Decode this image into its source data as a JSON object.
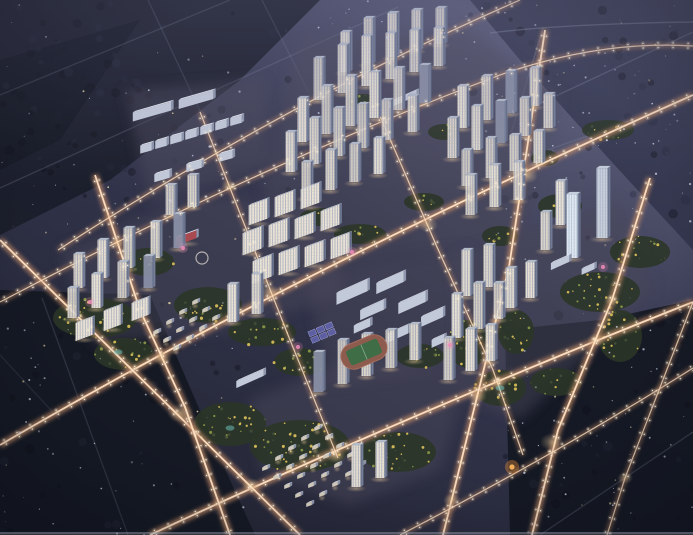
{
  "scene": {
    "title": "aerial-night-render-residential-masterplan",
    "canvas": {
      "w": 693,
      "h": 535
    },
    "palette": {
      "sky_top_right": "#6a6c88",
      "bg_light": "#4b4d68",
      "bg_dark": "#1e202c",
      "forest_dark": "#141823",
      "forest_tl": "#1a1d29",
      "forest_tr": "#2b2e44",
      "road_glow": "#c08a68",
      "road_core": "#ffe3c4",
      "lamp": "#fff2d8",
      "tower_lit": "#ebe4d6",
      "tower_stripe": "#a8aec2",
      "tower_floor": "#cfcabe",
      "tower_shade": "#747e97",
      "tower_shade_stripe": "#5f6882",
      "tower_roof": "#bcc3d1",
      "office_lit": "#e3ebf4",
      "office_stripe": "#b5c4d8",
      "office_roof": "#d4dde9",
      "school_front": "#c2c9d8",
      "school_roof": "#e3e7f0",
      "school_side": "#8d96ac",
      "villa_front": "#cfc7b8",
      "villa_roof": "#dde2ec",
      "villa_side": "#8a92a8",
      "green_base": "#2b3527",
      "tree_lit": "#d6bc58",
      "tree_mid": "#9aa84e",
      "tree_dark": "#46523a",
      "field_track": "#8e5c4e",
      "field_grass": "#3e6d46",
      "court_blue": "#5d5fa2",
      "court_line": "#9a9cd0",
      "pink_accent": "#ef8cba",
      "teal_accent": "#6fc9c4",
      "orange_accent": "#ffb95e",
      "kindergarten_red": "#a84a50",
      "speckle": "#d3d8ea",
      "bottom_strip": "#9fa3b2"
    },
    "roads": {
      "tier1": [
        {
          "d": "M 0,445 Q 300,270 693,95"
        },
        {
          "d": "M 150,535 Q 400,418 693,302"
        },
        {
          "d": "M 0,240 L 300,535"
        },
        {
          "d": "M 95,175 L 140,310 L 185,407 L 230,535"
        },
        {
          "d": "M 545,30 L 509,267 L 443,535"
        },
        {
          "d": "M 650,178 L 612,300 L 558,430 L 532,535"
        }
      ],
      "tier2": [
        {
          "d": "M 0,302 Q 260,165 500,75 Q 600,40 693,46"
        },
        {
          "d": "M 400,535 Q 560,452 693,368"
        },
        {
          "d": "M 200,112 L 290,340 L 338,458"
        },
        {
          "d": "M 373,100 L 437,247 L 493,370 L 523,455"
        },
        {
          "d": "M 693,302 L 625,478 L 607,535"
        },
        {
          "d": "M 58,250 Q 290,100 520,0"
        }
      ],
      "faint": [
        {
          "d": "M 0,95 L 230,0",
          "o": 0.22
        },
        {
          "d": "M 0,188 L 398,7",
          "o": 0.25
        },
        {
          "d": "M 148,0 L 208,128",
          "o": 0.2
        },
        {
          "d": "M 262,0 L 309,93",
          "o": 0.18
        },
        {
          "d": "M 500,122 L 693,32",
          "o": 0.3
        },
        {
          "d": "M 520,160 L 693,98",
          "o": 0.26
        },
        {
          "d": "M 490,33 Q 560,24 693,22",
          "o": 0.38
        },
        {
          "d": "M 543,28 L 509,140",
          "o": 0.3
        },
        {
          "d": "M 42,298 L 128,535",
          "o": 0.2
        },
        {
          "d": "M 540,535 L 693,432",
          "o": 0.25
        },
        {
          "d": "M 0,355 L 60,420",
          "o": 0.15
        }
      ]
    },
    "intersections": [
      [
        180,
        413,
        13
      ],
      [
        162,
        358,
        10
      ],
      [
        270,
        292,
        10
      ],
      [
        428,
        225,
        10
      ],
      [
        528,
        176,
        10
      ],
      [
        336,
        456,
        10
      ],
      [
        477,
        396,
        10
      ],
      [
        552,
        442,
        12
      ],
      [
        229,
        186,
        8
      ],
      [
        117,
        243,
        7
      ],
      [
        378,
        113,
        8
      ],
      [
        498,
        382,
        9
      ],
      [
        596,
        340,
        9
      ],
      [
        452,
        500,
        9
      ],
      [
        251,
        485,
        9
      ],
      [
        612,
        300,
        8
      ],
      [
        625,
        478,
        8
      ]
    ],
    "pads": [
      {
        "pts": [
          [
            300,
            38
          ],
          [
            470,
            30
          ],
          [
            560,
            95
          ],
          [
            525,
            235
          ],
          [
            300,
            272
          ],
          [
            262,
            190
          ]
        ]
      },
      {
        "pts": [
          [
            60,
            250
          ],
          [
            200,
            195
          ],
          [
            330,
            210
          ],
          [
            345,
            295
          ],
          [
            230,
            330
          ],
          [
            95,
            345
          ]
        ]
      },
      {
        "pts": [
          [
            305,
            272
          ],
          [
            470,
            248
          ],
          [
            505,
            362
          ],
          [
            330,
            385
          ]
        ]
      },
      {
        "pts": [
          [
            250,
            400
          ],
          [
            350,
            360
          ],
          [
            470,
            370
          ],
          [
            440,
            470
          ],
          [
            350,
            505
          ],
          [
            262,
            470
          ]
        ]
      },
      {
        "pts": [
          [
            455,
            255
          ],
          [
            620,
            200
          ],
          [
            655,
            290
          ],
          [
            520,
            420
          ],
          [
            460,
            395
          ]
        ]
      },
      {
        "pts": [
          [
            125,
            90
          ],
          [
            265,
            80
          ],
          [
            270,
            165
          ],
          [
            150,
            205
          ]
        ]
      }
    ],
    "forests": [
      {
        "pts": [
          [
            0,
            0
          ],
          [
            320,
            0
          ],
          [
            240,
            80
          ],
          [
            110,
            180
          ],
          [
            0,
            235
          ]
        ],
        "fill": "forest_tl",
        "o": 0.9
      },
      {
        "pts": [
          [
            0,
            60
          ],
          [
            140,
            20
          ],
          [
            60,
            140
          ],
          [
            0,
            170
          ]
        ],
        "fill": "forest_dark",
        "o": 0.8
      },
      {
        "pts": [
          [
            0,
            290
          ],
          [
            150,
            295
          ],
          [
            230,
            480
          ],
          [
            255,
            535
          ],
          [
            0,
            535
          ]
        ],
        "fill": "forest_dark",
        "o": 0.95
      },
      {
        "pts": [
          [
            505,
            330
          ],
          [
            600,
            320
          ],
          [
            693,
            300
          ],
          [
            693,
            535
          ],
          [
            510,
            535
          ]
        ],
        "fill": "forest_dark",
        "o": 0.95
      },
      {
        "pts": [
          [
            470,
            0
          ],
          [
            693,
            0
          ],
          [
            693,
            250
          ],
          [
            610,
            160
          ],
          [
            520,
            60
          ]
        ],
        "fill": "forest_tr",
        "o": 0.7
      }
    ],
    "greens": [
      [
        95,
        318,
        42,
        20
      ],
      [
        148,
        262,
        26,
        14
      ],
      [
        208,
        305,
        34,
        18
      ],
      [
        262,
        332,
        34,
        14
      ],
      [
        300,
        362,
        26,
        14
      ],
      [
        124,
        354,
        30,
        16
      ],
      [
        230,
        424,
        36,
        22
      ],
      [
        300,
        446,
        50,
        26
      ],
      [
        398,
        452,
        38,
        20
      ],
      [
        420,
        356,
        24,
        12
      ],
      [
        468,
        344,
        20,
        24
      ],
      [
        516,
        332,
        18,
        22
      ],
      [
        600,
        292,
        40,
        20
      ],
      [
        640,
        252,
        30,
        16
      ],
      [
        560,
        206,
        22,
        12
      ],
      [
        500,
        388,
        26,
        18
      ],
      [
        556,
        382,
        26,
        14
      ],
      [
        620,
        336,
        22,
        26
      ],
      [
        360,
        234,
        26,
        10
      ],
      [
        320,
        217,
        20,
        9
      ],
      [
        424,
        202,
        20,
        9
      ],
      [
        444,
        132,
        16,
        8
      ],
      [
        364,
        102,
        16,
        8
      ],
      [
        500,
        236,
        18,
        10
      ],
      [
        545,
        158,
        14,
        8
      ],
      [
        608,
        130,
        26,
        10
      ]
    ],
    "towers": [
      [
        345,
        72,
        40
      ],
      [
        368,
        64,
        46
      ],
      [
        392,
        57,
        44
      ],
      [
        416,
        50,
        40
      ],
      [
        440,
        44,
        36
      ],
      [
        318,
        100,
        42
      ],
      [
        342,
        93,
        48
      ],
      [
        366,
        86,
        50
      ],
      [
        390,
        79,
        46
      ],
      [
        414,
        72,
        42
      ],
      [
        438,
        66,
        38
      ],
      [
        302,
        142,
        44
      ],
      [
        326,
        134,
        48
      ],
      [
        350,
        126,
        50
      ],
      [
        374,
        118,
        46
      ],
      [
        398,
        110,
        42
      ],
      [
        424,
        103,
        38
      ],
      [
        290,
        172,
        40
      ],
      [
        314,
        164,
        46
      ],
      [
        338,
        156,
        48
      ],
      [
        362,
        148,
        44
      ],
      [
        386,
        140,
        40
      ],
      [
        412,
        132,
        36
      ],
      [
        306,
        198,
        36
      ],
      [
        330,
        190,
        40
      ],
      [
        354,
        182,
        38
      ],
      [
        378,
        174,
        36
      ],
      [
        462,
        128,
        42
      ],
      [
        486,
        120,
        44
      ],
      [
        510,
        113,
        42
      ],
      [
        534,
        106,
        38
      ],
      [
        452,
        158,
        40
      ],
      [
        476,
        150,
        44
      ],
      [
        500,
        143,
        42
      ],
      [
        524,
        136,
        38
      ],
      [
        548,
        128,
        34
      ],
      [
        466,
        186,
        36
      ],
      [
        490,
        178,
        40
      ],
      [
        514,
        171,
        36
      ],
      [
        538,
        163,
        32
      ],
      [
        470,
        215,
        40
      ],
      [
        494,
        207,
        42
      ],
      [
        518,
        200,
        38
      ],
      [
        560,
        225,
        44
      ],
      [
        545,
        250,
        38
      ],
      [
        78,
        288,
        34
      ],
      [
        102,
        278,
        38
      ],
      [
        128,
        268,
        40
      ],
      [
        155,
        258,
        36
      ],
      [
        178,
        248,
        34
      ],
      [
        72,
        318,
        30
      ],
      [
        96,
        308,
        34
      ],
      [
        122,
        298,
        36
      ],
      [
        148,
        288,
        32
      ],
      [
        170,
        215,
        30
      ],
      [
        192,
        207,
        32
      ],
      [
        232,
        322,
        38
      ],
      [
        256,
        314,
        40
      ],
      [
        318,
        392,
        40
      ],
      [
        342,
        384,
        44
      ],
      [
        366,
        376,
        42
      ],
      [
        390,
        368,
        38
      ],
      [
        414,
        360,
        36
      ],
      [
        356,
        487,
        42
      ],
      [
        380,
        478,
        36
      ],
      [
        466,
        296,
        46
      ],
      [
        488,
        287,
        42
      ],
      [
        456,
        338,
        44
      ],
      [
        478,
        329,
        46
      ],
      [
        498,
        319,
        36
      ],
      [
        448,
        380,
        42
      ],
      [
        470,
        371,
        42
      ],
      [
        490,
        361,
        36
      ],
      [
        510,
        308,
        40
      ],
      [
        530,
        298,
        36
      ]
    ],
    "offices": [
      [
        572,
        258,
        64,
        11
      ],
      [
        602,
        238,
        70,
        11
      ]
    ],
    "slabs": [
      [
        84,
        338,
        18,
        18
      ],
      [
        112,
        328,
        20,
        18
      ],
      [
        140,
        318,
        18,
        18
      ],
      [
        258,
        222,
        20,
        20
      ],
      [
        284,
        214,
        20,
        20
      ],
      [
        310,
        206,
        20,
        20
      ],
      [
        252,
        252,
        22,
        20
      ],
      [
        278,
        244,
        22,
        20
      ],
      [
        304,
        236,
        20,
        20
      ],
      [
        330,
        228,
        20,
        20
      ],
      [
        262,
        280,
        22,
        20
      ],
      [
        288,
        272,
        22,
        20
      ],
      [
        314,
        264,
        20,
        20
      ],
      [
        340,
        256,
        20,
        20
      ]
    ],
    "school_slabs": [
      [
        352,
        298,
        12,
        34
      ],
      [
        390,
        288,
        11,
        30
      ],
      [
        372,
        315,
        10,
        26
      ],
      [
        412,
        308,
        11,
        30
      ],
      [
        432,
        322,
        10,
        24
      ],
      [
        398,
        338,
        9,
        22
      ],
      [
        362,
        330,
        8,
        18
      ],
      [
        438,
        345,
        8,
        14
      ],
      [
        403,
        102,
        6,
        30
      ],
      [
        250,
        382,
        7,
        30
      ],
      [
        560,
        266,
        7,
        20
      ],
      [
        588,
        272,
        6,
        14
      ]
    ],
    "kindergarten": {
      "x": 186,
      "y": 242,
      "h": 8,
      "len": 22,
      "plaza": [
        202,
        258,
        6
      ]
    },
    "strip": {
      "long": [
        [
          152,
          116,
          9,
          40
        ],
        [
          196,
          104,
          9,
          36
        ]
      ],
      "units": {
        "origin": [
          146,
          152
        ],
        "step": [
          15,
          -4.6
        ],
        "count": 7,
        "len": 12,
        "h": 8
      },
      "blocks": [
        [
          162,
          180,
          8,
          16
        ],
        [
          194,
          170,
          8,
          16
        ],
        [
          226,
          160,
          8,
          14
        ]
      ]
    },
    "villa_fields": [
      {
        "origin": [
          265,
          470
        ],
        "rowDir": [
          13,
          -10
        ],
        "colDir": [
          11,
          9
        ],
        "rows": 5,
        "cols": 5
      },
      {
        "origin": [
          156,
          334
        ],
        "rowDir": [
          13,
          -10
        ],
        "colDir": [
          10,
          8
        ],
        "rows": 4,
        "cols": 3
      }
    ],
    "sports_field": {
      "x": 364,
      "y": 352,
      "angle": -23,
      "track_w": 48,
      "track_h": 26,
      "grass_w": 34,
      "grass_h": 16
    },
    "courts": {
      "x": 323,
      "y": 333,
      "angle": -23,
      "cw": 7.5,
      "ch": 5.5,
      "rows": 2,
      "cols": 3,
      "gap": 1.5
    },
    "accents": {
      "pink": [
        [
          183,
          248
        ],
        [
          90,
          302
        ],
        [
          352,
          252
        ],
        [
          603,
          267
        ],
        [
          298,
          347
        ],
        [
          450,
          345
        ]
      ],
      "teal": [
        [
          118,
          352
        ],
        [
          230,
          428
        ],
        [
          500,
          388
        ]
      ],
      "orange": [
        [
          512,
          467
        ]
      ]
    },
    "speckle_regions": [
      [
        0,
        0,
        330,
        240,
        55
      ],
      [
        470,
        0,
        223,
        150,
        40
      ],
      [
        480,
        60,
        213,
        200,
        45
      ],
      [
        0,
        290,
        250,
        245,
        65
      ],
      [
        505,
        310,
        188,
        225,
        60
      ],
      [
        330,
        0,
        160,
        60,
        18
      ]
    ],
    "bottom_strip": {
      "y": 532,
      "h": 2.5
    }
  }
}
